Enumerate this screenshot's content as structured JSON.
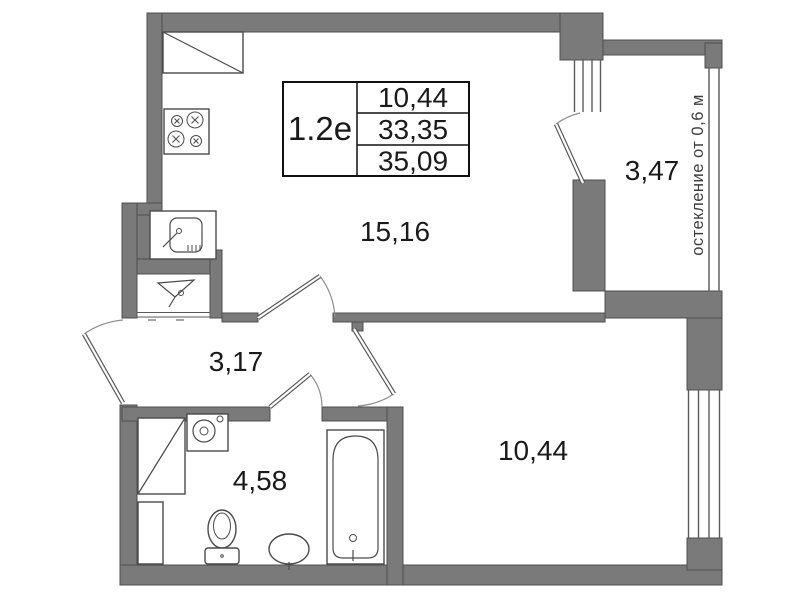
{
  "info_table": {
    "type_label": "1.2е",
    "rows": [
      "10,44",
      "33,35",
      "35,09"
    ]
  },
  "rooms": {
    "kitchen_living": {
      "label": "15,16"
    },
    "balcony": {
      "label": "3,47"
    },
    "hallway": {
      "label": "3,17"
    },
    "bathroom": {
      "label": "4,58"
    },
    "bedroom": {
      "label": "10,44"
    }
  },
  "annotations": {
    "glazing_note": "остекление от 0,6 м"
  },
  "fixtures": [
    "kitchen-counter",
    "stove",
    "kitchen-sink-unit",
    "vent-funnel",
    "washing-machine",
    "shower-cabinet",
    "duct",
    "toilet",
    "washbasin",
    "bathtub"
  ],
  "colors": {
    "wall": "#7a7a7a",
    "wall_outline": "#4f4f4f",
    "fixture_line": "#4a4a4a",
    "text": "#1a1a1a",
    "background": "#ffffff"
  }
}
